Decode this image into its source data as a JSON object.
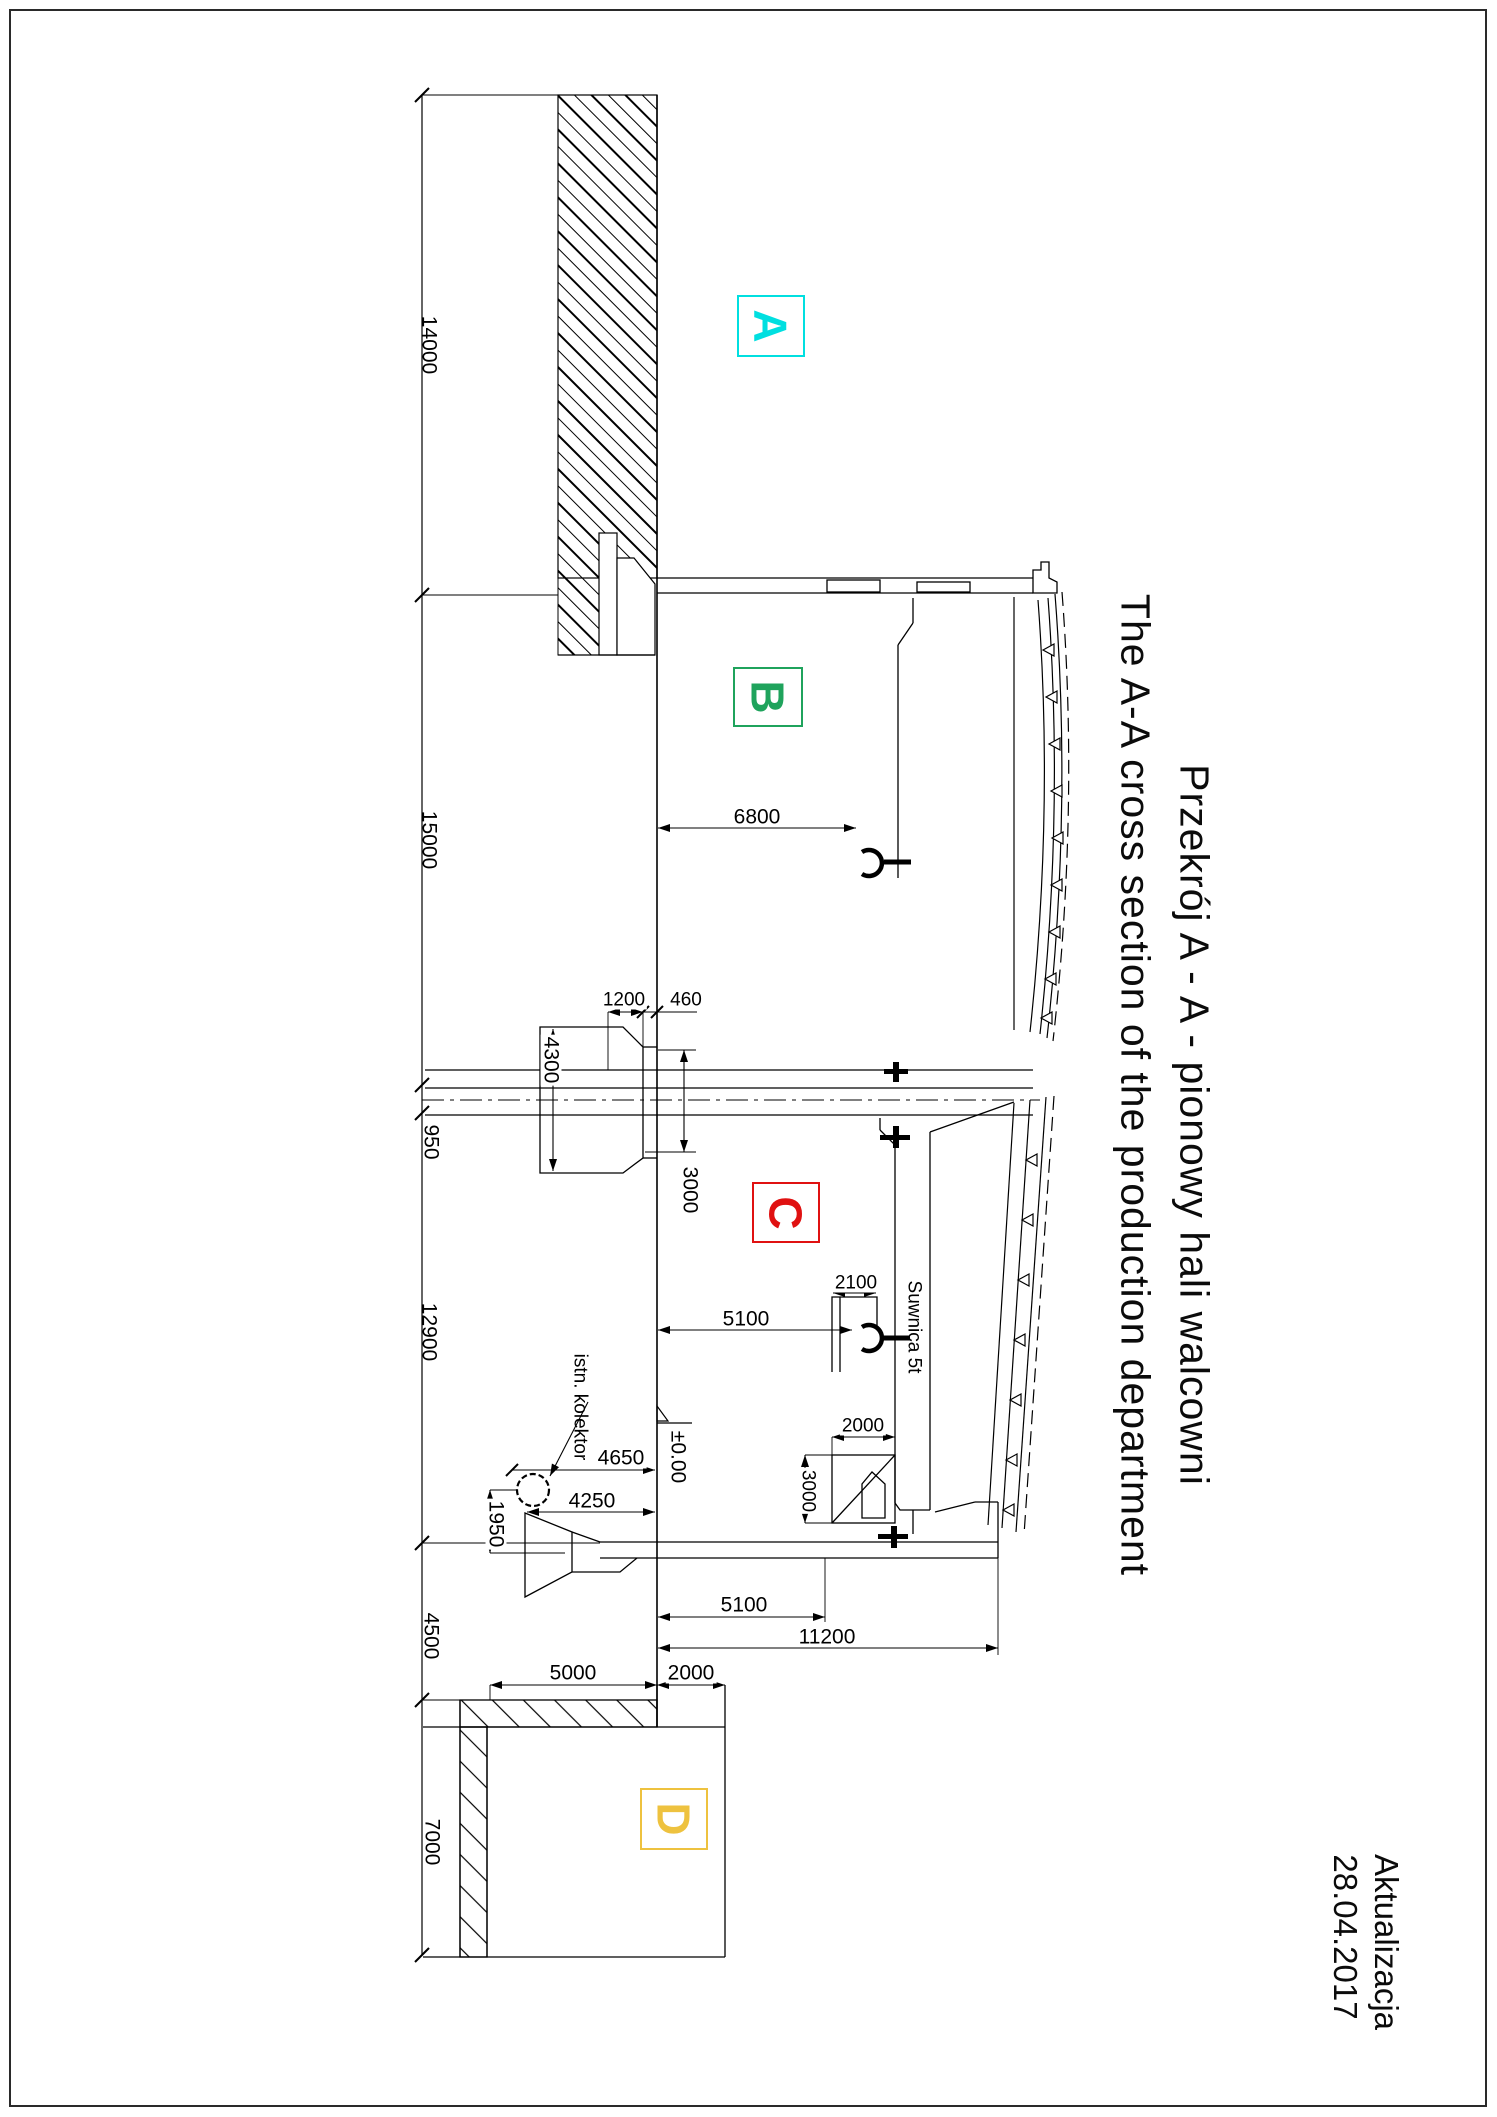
{
  "drawing": {
    "title_pl": "Przekrój A - A - pionowy hali walcowni",
    "title_en": "The A-A cross section of the production department",
    "revision_label": "Aktualizacja",
    "revision_date": "28.04.2017"
  },
  "zones": {
    "a": {
      "label": "A",
      "color": "#00dfe0"
    },
    "b": {
      "label": "B",
      "color": "#1fa35c"
    },
    "c": {
      "label": "C",
      "color": "#e01111"
    },
    "d": {
      "label": "D",
      "color": "#eec23f"
    }
  },
  "labels": {
    "collector": "istn. kolektor",
    "crane": "Suwnica 5t",
    "level": "±0.00"
  },
  "dims": {
    "chain": [
      "14000",
      "15000",
      "950",
      "12900",
      "4500",
      "7000"
    ],
    "bayB": "6800",
    "head1200": "1200",
    "head460": "460",
    "head4300": "4300",
    "col3000": "3000",
    "hook5100": "5100",
    "bracket2100": "2100",
    "machine2000": "2000",
    "machine3000": "3000",
    "kolektor4650": "4650",
    "kolektor4250": "4250",
    "kolektor1950": "1950",
    "floor5100": "5100",
    "floor11200": "11200",
    "hallD5000": "5000",
    "hallD2000": "2000"
  }
}
